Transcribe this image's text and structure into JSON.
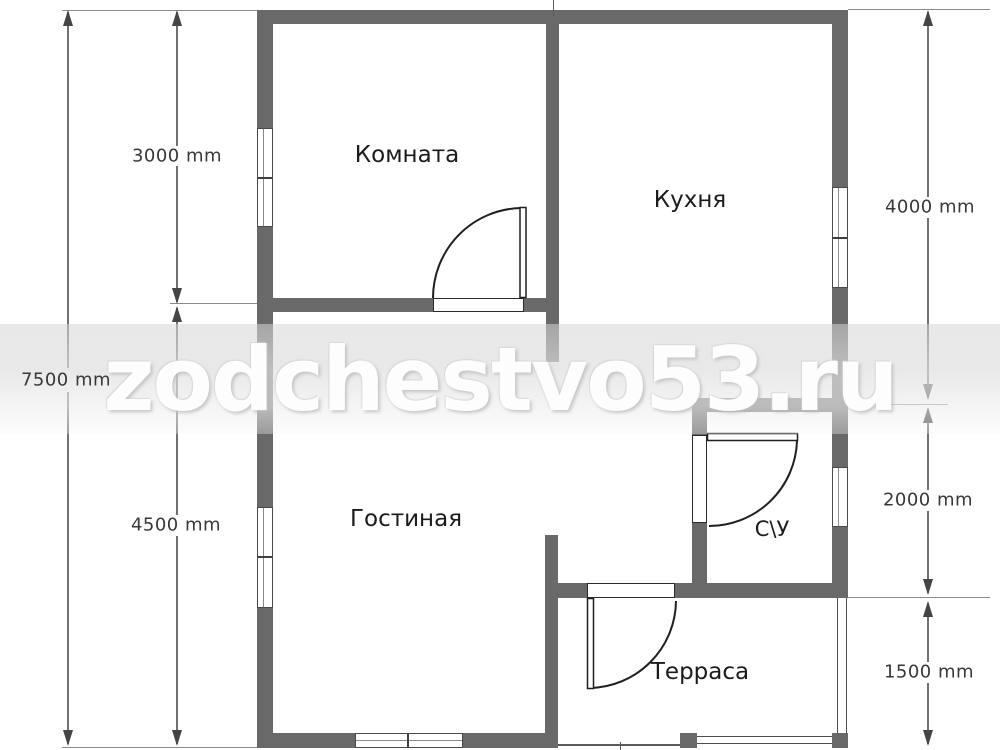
{
  "watermark": {
    "text": "zodchestvo53.ru"
  },
  "rooms": {
    "komnata": {
      "label": "Комната"
    },
    "kuhnya": {
      "label": "Кухня"
    },
    "gostinaya": {
      "label": "Гостиная"
    },
    "su": {
      "label": "С\\У"
    },
    "terrasa": {
      "label": "Терраса"
    }
  },
  "dimensions": {
    "total_height": {
      "value": "7500 mm"
    },
    "komnata_height": {
      "value": "3000 mm"
    },
    "gostinaya_height": {
      "value": "4500 mm"
    },
    "kuhnya_height": {
      "value": "4000 mm"
    },
    "su_height": {
      "value": "2000 mm"
    },
    "terrasa_height": {
      "value": "1500 mm"
    }
  },
  "colors": {
    "wall": "#696969",
    "dimension_line": "#707070",
    "arrow": "#454545",
    "dimension_text": "#383838",
    "room_text": "#1b1b1b",
    "watermark_text": "#ffffff"
  }
}
